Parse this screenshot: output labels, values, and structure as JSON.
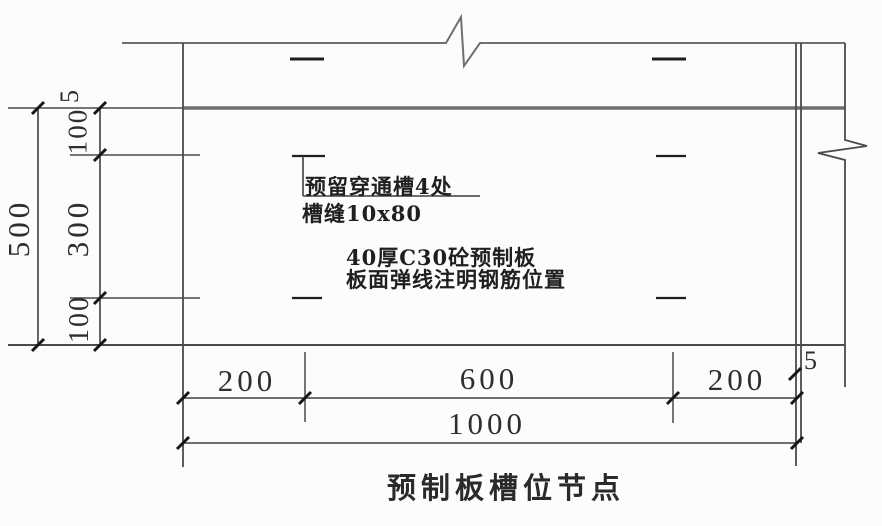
{
  "title": "预制板槽位节点",
  "annotations": {
    "leader_line1": "预留穿通槽4处",
    "leader_line2": "槽缝10x80",
    "note_line1": "40厚C30砼预制板",
    "note_line2": "板面弹线注明钢筋位置"
  },
  "dimensions": {
    "left_outer": "500",
    "left_chain": [
      "5",
      "100",
      "300",
      "100"
    ],
    "bottom_chain": [
      "200",
      "600",
      "200"
    ],
    "bottom_overall": "1000",
    "right_gap": "5"
  },
  "colors": {
    "background": "#fcfcfc",
    "thin_line": "#4a4a4a",
    "thick_line": "#6f6f6f",
    "tick": "#161616",
    "text": "#2a2a2a"
  }
}
